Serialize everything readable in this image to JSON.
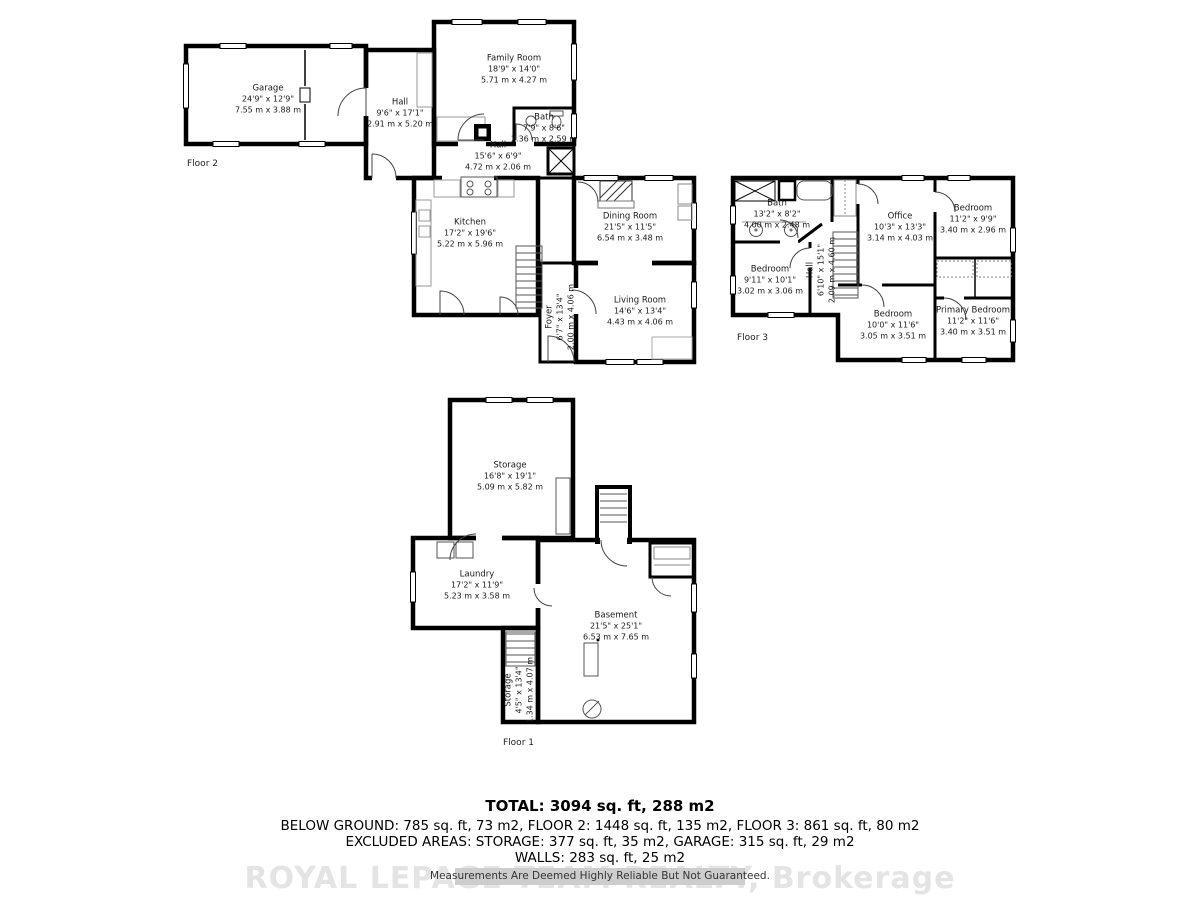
{
  "colors": {
    "wall": "#000000",
    "watermark": "#e4e4e4",
    "band": "#cdcdcd",
    "text": "#1a1a1a"
  },
  "floors": [
    {
      "label": "Floor 2",
      "rooms": [
        {
          "name": "Garage",
          "imperial": "24'9\" x 12'9\"",
          "metric": "7.55 m x 3.88 m"
        },
        {
          "name": "Hall",
          "imperial": "9'6\" x 17'1\"",
          "metric": "2.91 m x 5.20 m"
        },
        {
          "name": "Family Room",
          "imperial": "18'9\" x 14'0\"",
          "metric": "5.71 m x 4.27 m"
        },
        {
          "name": "Bath",
          "imperial": "7'9\" x 8'6\"",
          "metric": "2.36 m x 2.59 m"
        },
        {
          "name": "Hall",
          "imperial": "15'6\" x 6'9\"",
          "metric": "4.72 m x 2.06 m"
        },
        {
          "name": "Kitchen",
          "imperial": "17'2\" x 19'6\"",
          "metric": "5.22 m x 5.96 m"
        },
        {
          "name": "Dining Room",
          "imperial": "21'5\" x 11'5\"",
          "metric": "6.54 m x 3.48 m"
        },
        {
          "name": "Foyer",
          "imperial": "6'7\" x 13'4\"",
          "metric": "2.00 m x 4.06 m"
        },
        {
          "name": "Living Room",
          "imperial": "14'6\" x 13'4\"",
          "metric": "4.43 m x 4.06 m"
        }
      ]
    },
    {
      "label": "Floor 3",
      "rooms": [
        {
          "name": "Bath",
          "imperial": "13'2\" x 8'2\"",
          "metric": "4.00 m x 2.48 m"
        },
        {
          "name": "Bedroom",
          "imperial": "9'11\" x 10'1\"",
          "metric": "3.02 m x 3.06 m"
        },
        {
          "name": "Hall",
          "imperial": "6'10\" x 15'1\"",
          "metric": "2.09 m x 4.60 m"
        },
        {
          "name": "Office",
          "imperial": "10'3\" x 13'3\"",
          "metric": "3.14 m x 4.03 m"
        },
        {
          "name": "Bedroom",
          "imperial": "11'2\" x 9'9\"",
          "metric": "3.40 m x 2.96 m"
        },
        {
          "name": "Bedroom",
          "imperial": "10'0\" x 11'6\"",
          "metric": "3.05 m x 3.51 m"
        },
        {
          "name": "Primary Bedroom",
          "imperial": "11'2\" x 11'6\"",
          "metric": "3.40 m x 3.51 m"
        }
      ]
    },
    {
      "label": "Floor 1",
      "rooms": [
        {
          "name": "Storage",
          "imperial": "16'8\" x 19'1\"",
          "metric": "5.09 m x 5.82 m"
        },
        {
          "name": "Laundry",
          "imperial": "17'2\" x 11'9\"",
          "metric": "5.23 m x 3.58 m"
        },
        {
          "name": "Basement",
          "imperial": "21'5\" x 25'1\"",
          "metric": "6.53 m x 7.65 m"
        },
        {
          "name": "Storage",
          "imperial": "4'5\" x 13'4\"",
          "metric": "1.34 m x 4.07 m"
        }
      ]
    }
  ],
  "summary": {
    "total": "TOTAL: 3094 sq. ft, 288 m2",
    "by_floor": "BELOW GROUND: 785 sq. ft, 73 m2, FLOOR 2: 1448 sq. ft, 135 m2, FLOOR 3: 861 sq. ft, 80 m2",
    "excluded": "EXCLUDED AREAS: STORAGE: 377 sq. ft, 35 m2, GARAGE: 315 sq. ft, 29 m2",
    "walls": "WALLS: 283 sq. ft, 25 m2",
    "disclaimer": "Measurements Are Deemed Highly Reliable But Not Guaranteed.",
    "watermark": "ROYAL LEPAGE TEAM REALTY, Brokerage"
  }
}
